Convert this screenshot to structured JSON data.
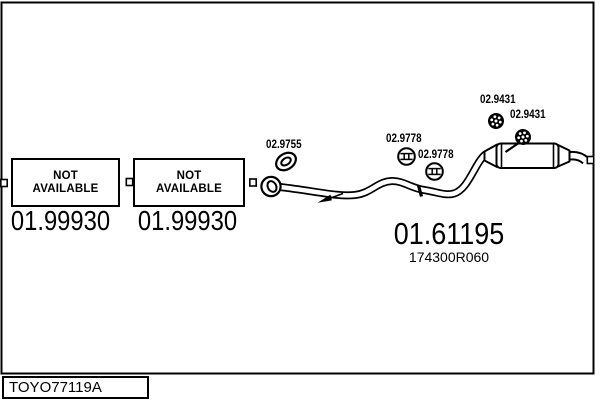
{
  "colors": {
    "ink": "#000000",
    "background": "#ffffff"
  },
  "drawing_code": {
    "label": "TOYO77119A"
  },
  "unavailable_slots": [
    {
      "status_label": "NOT AVAILABLE",
      "part_number": "01.99930",
      "icon": "connector-square"
    },
    {
      "status_label": "NOT AVAILABLE",
      "part_number": "01.99930",
      "icon": "connector-square"
    }
  ],
  "parts": {
    "gasket_ring": {
      "part_number": "02.9755",
      "icon": "gasket-ring-icon"
    },
    "clamp_front": {
      "part_number": "02.9778",
      "icon": "pipe-clamp-icon"
    },
    "clamp_rear": {
      "part_number": "02.9778",
      "icon": "pipe-clamp-icon"
    },
    "hanger_mount_upper": {
      "part_number": "02.9431",
      "icon": "rubber-mount-icon"
    },
    "hanger_mount_lower": {
      "part_number": "02.9431",
      "icon": "rubber-mount-icon"
    },
    "rear_silencer": {
      "part_number": "01.61195",
      "oem_reference": "174300R060"
    }
  }
}
